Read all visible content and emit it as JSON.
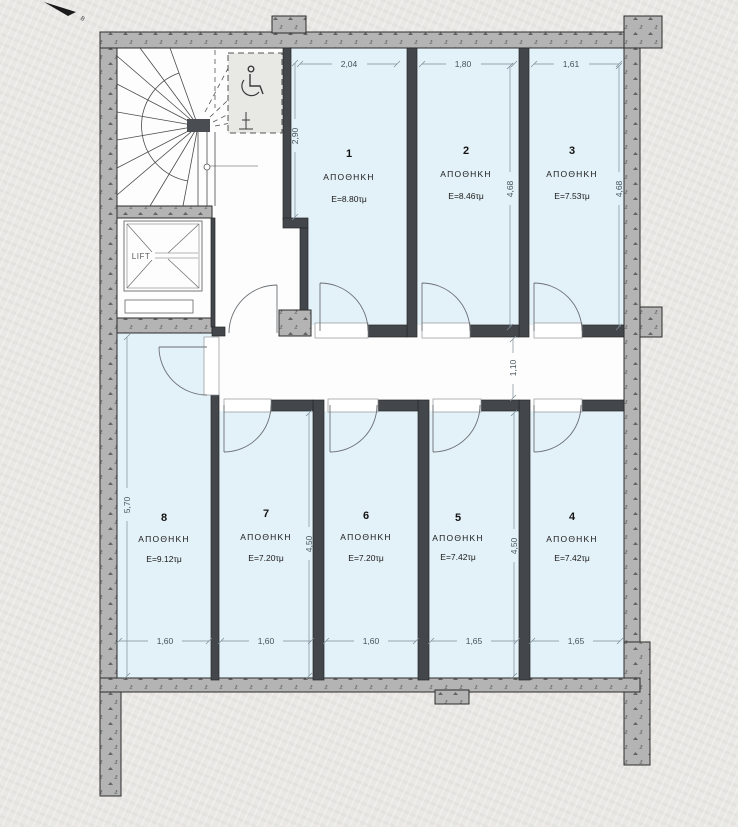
{
  "north": {
    "label": "Β"
  },
  "lift": {
    "label": "LIFT"
  },
  "rooms": [
    {
      "number": "1",
      "name": "ΑΠΟΘΗΚΗ",
      "area": "E=8.80τμ"
    },
    {
      "number": "2",
      "name": "ΑΠΟΘΗΚΗ",
      "area": "E=8.46τμ"
    },
    {
      "number": "3",
      "name": "ΑΠΟΘΗΚΗ",
      "area": "E=7.53τμ"
    },
    {
      "number": "4",
      "name": "ΑΠΟΘΗΚΗ",
      "area": "E=7.42τμ"
    },
    {
      "number": "5",
      "name": "ΑΠΟΘΗΚΗ",
      "area": "E=7.42τμ"
    },
    {
      "number": "6",
      "name": "ΑΠΟΘΗΚΗ",
      "area": "E=7.20τμ"
    },
    {
      "number": "7",
      "name": "ΑΠΟΘΗΚΗ",
      "area": "E=7.20τμ"
    },
    {
      "number": "8",
      "name": "ΑΠΟΘΗΚΗ",
      "area": "E=9.12τμ"
    }
  ],
  "dimensions": {
    "top": [
      "2,04",
      "1,80",
      "1,61"
    ],
    "room1_height": "2,90",
    "room2_height": "4,68",
    "room3_height": "4,68",
    "corridor_width": "1,10",
    "room8_height": "5,70",
    "room7_height": "4,50",
    "room5_height": "4,50",
    "bottom": [
      "1,60",
      "1,60",
      "1,60",
      "1,65",
      "1,65"
    ]
  },
  "colors": {
    "wall_fill": "#b4b4b4",
    "partition": "#43474b",
    "room_floor": "#e3f1f8",
    "dimension": "#44525c",
    "background": "#e9e8e4"
  }
}
